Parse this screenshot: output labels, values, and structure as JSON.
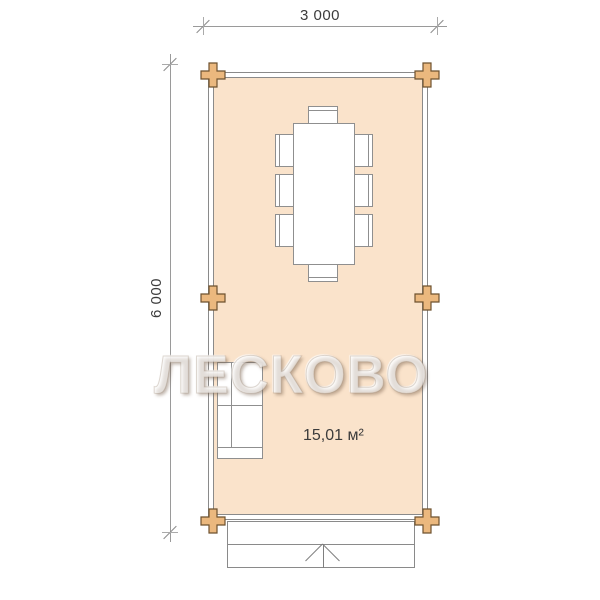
{
  "dimensions": {
    "width_label": "3 000",
    "height_label": "6 000"
  },
  "room": {
    "area_label": "15,01 м²"
  },
  "watermark_text": "ЛЕСКОВО",
  "icons": {
    "timber_joint": "plus-cross",
    "stairs_direction": "chevron-up-arrow",
    "dimension_tick": "diagonal-slash"
  },
  "colors": {
    "floor_fill": "#FAE3CB",
    "timber_fill": "#EBB87E",
    "timber_border": "#6E522F",
    "wall_line": "#8A8A8A",
    "dim_line": "#9A9A9A",
    "text": "#3C3C3C"
  }
}
